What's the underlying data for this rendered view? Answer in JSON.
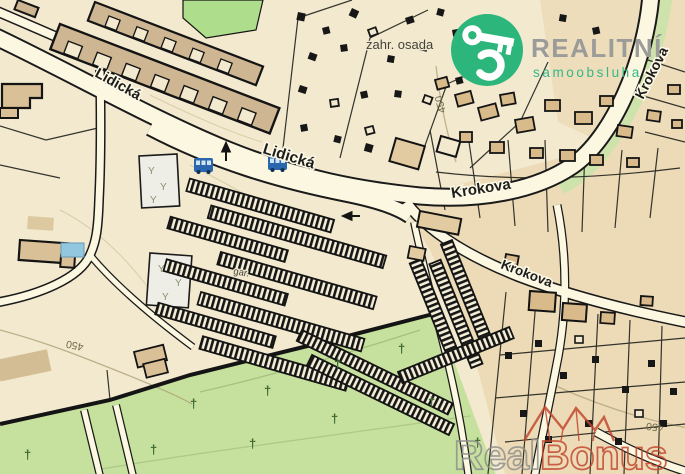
{
  "labels": {
    "lidicka_west": "Lidická",
    "lidicka_center": "Lidická",
    "krokova_main": "Krokova",
    "krokova_south": "Krokova",
    "krokova_north": "Krokova",
    "garden_settlement": "zahr. osada",
    "garages": "gar.",
    "contour_sw": "450",
    "contour_e": "450",
    "contour_se": "450"
  },
  "logo": {
    "brand": "REALITNÍ",
    "tagline": "samoobsluha",
    "icon": "key-icon",
    "circle_color": "#2cb67c",
    "brand_color": "#9b9b99",
    "tagline_color": "#35b789"
  },
  "watermark": {
    "part1": "Real",
    "part2": "Bonus",
    "icon": "roof-crown-icon",
    "part1_color": "#8e8e8c",
    "part2_color": "#c2452c"
  },
  "symbols": {
    "cross": "†",
    "tree": "Y",
    "bus_stop_count": "2",
    "contour_elevation": "450"
  },
  "colors": {
    "background": "#f2e9cf",
    "road_fill": "#fbf7e1",
    "road_casing": "#1a1a1a",
    "parcel_tan": "#ecdbb6",
    "building_fill": "#d9ba8b",
    "block_fill": "#cdb691",
    "green_area": "#c6e09d",
    "green_bright": "#aede8c",
    "green_strip": "#cde3ab",
    "water": "#93c7e0",
    "bus_icon": "#2a66ad",
    "contour": "#b3a57c"
  }
}
